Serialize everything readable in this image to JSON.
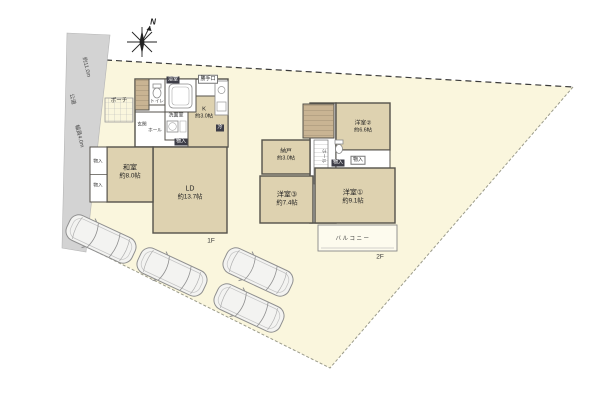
{
  "colors": {
    "site_fill": "#faf6dd",
    "road_fill": "#d3d3d3",
    "room_fill": "#ded2b0",
    "stair_fill": "#c9b493",
    "wall": "#54524b",
    "balcony_fill": "#fdfbee"
  },
  "compass": {
    "north": "N"
  },
  "road": {
    "name": "公道",
    "frontage": "約11.0m",
    "width": "幅員4.0m"
  },
  "common": {
    "storage": "物入"
  },
  "floor1": {
    "label": "1F",
    "washitsu": {
      "name": "和室",
      "size": "約8.0帖"
    },
    "ld": {
      "name": "LD",
      "size": "約13.7帖"
    },
    "kitchen": {
      "name": "K",
      "size": "約3.0帖"
    },
    "bath": "浴室",
    "washroom": "洗面室",
    "toilet": "トイレ",
    "entrance": "玄関",
    "hall": "ホール",
    "porch": "ポーチ",
    "back_door": "勝手口",
    "fridge": "冷"
  },
  "floor2": {
    "label": "2F",
    "room1": {
      "name": "洋室①",
      "size": "約9.1帖"
    },
    "room2": {
      "name": "洋室②",
      "size": "約6.6帖"
    },
    "room3": {
      "name": "洋室③",
      "size": "約7.4帖"
    },
    "storage_room": {
      "name": "納戸",
      "size": "約3.0帖"
    },
    "hall": "ホール",
    "balcony": "バルコニー"
  }
}
